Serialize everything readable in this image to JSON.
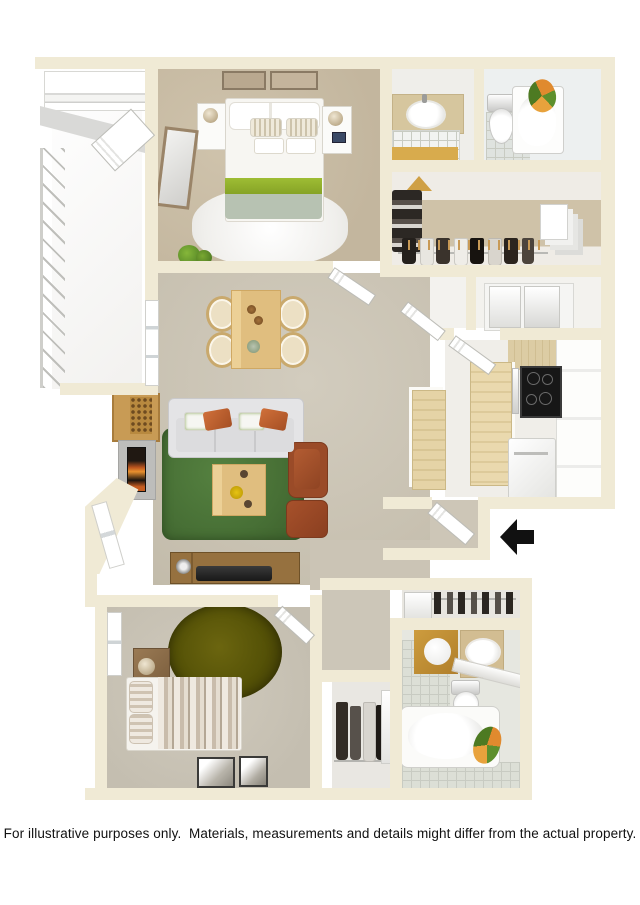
{
  "caption": {
    "text": "For illustrative purposes only.  Materials, measurements and details might differ from the actual property."
  },
  "scene": {
    "type": "3d-floor-plan",
    "rooms": [
      "balcony",
      "bedroom-1",
      "bathroom-1-sink-room",
      "bathroom-1-tub-room",
      "walk-in-closet",
      "dining-area",
      "living-room",
      "kitchen",
      "entry",
      "hall-closet",
      "bedroom-2",
      "bathroom-2",
      "coat-closet"
    ],
    "entry_indicator": "black arrow pointing left at the front door"
  },
  "icons": {
    "entry_arrow": "left-arrow"
  },
  "colors": {
    "background": "#ffffff",
    "wall_cream": "#f0ead5",
    "carpet_greatroom": "#cdc6b7",
    "carpet_bedroom1": "#c9bda6",
    "rug_green": "#4a7239",
    "rug_olive": "#555207",
    "bed_accent_green": "#94b32c",
    "blanket_sage": "#b7c2b2",
    "sofa_gray": "#dcdcde",
    "pillow_orange": "#c06233",
    "armchair_rust": "#9a4b28",
    "wood_light": "#ecd096",
    "wood_console": "#8d6a3b",
    "gold_accent": "#c29136",
    "arrow_black": "#111111",
    "caption_text": "#111111"
  }
}
